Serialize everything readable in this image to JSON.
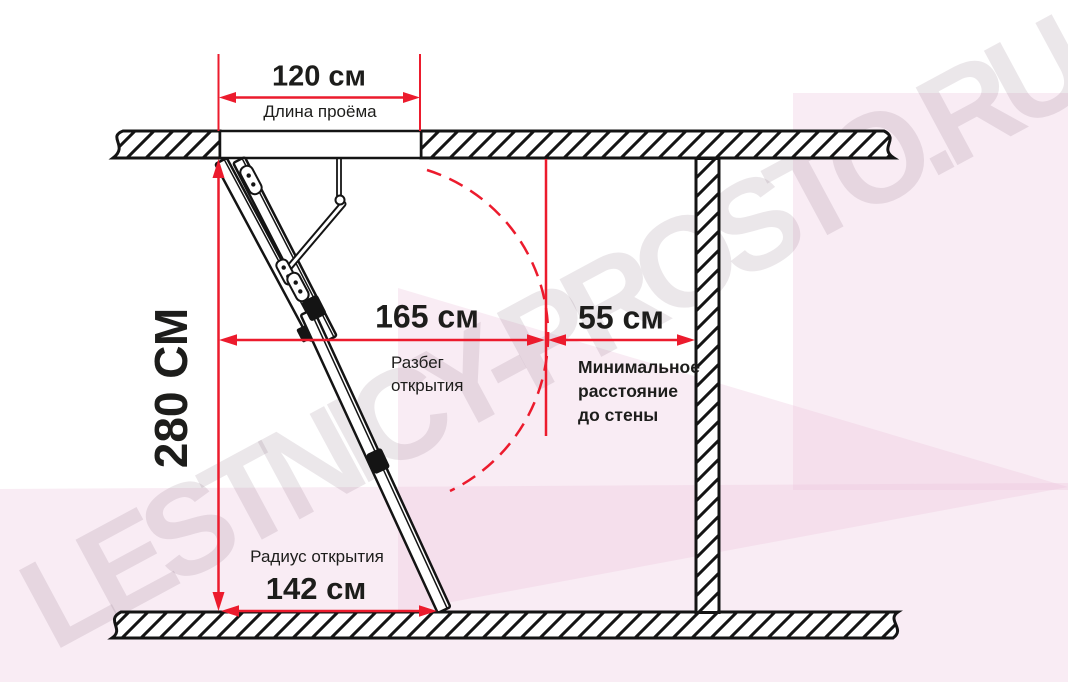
{
  "watermark": {
    "text": "LESTNICY-PROSTO.RU"
  },
  "colors": {
    "dimension_red": "#ec1b2d",
    "drawing_black": "#141414",
    "background_tint": "#f8ecf4"
  },
  "dimensions": {
    "opening_length": {
      "value": "120 см",
      "label": "Длина проёма"
    },
    "ceiling_height": {
      "value": "280 СМ"
    },
    "opening_run": {
      "value": "165 см",
      "label": "Разбег открытия"
    },
    "min_wall_distance": {
      "value": "55 см",
      "label": "Минимальное расстояние до стены"
    },
    "opening_radius": {
      "value": "142 см",
      "label": "Радиус открытия"
    }
  }
}
